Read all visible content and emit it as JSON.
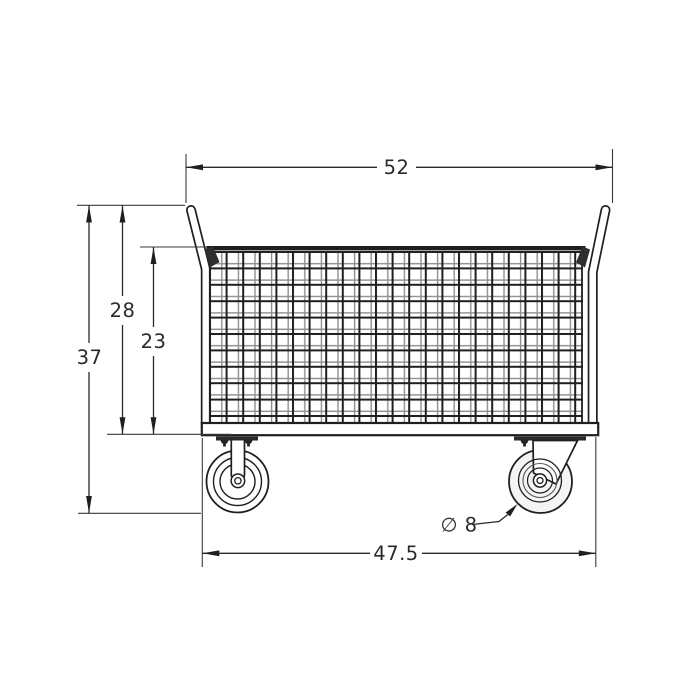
{
  "drawing": {
    "kind": "technical dimension drawing",
    "subject": "wire mesh cage platform cart, side elevation",
    "labels": {
      "overall_width": "52",
      "overall_height": "37",
      "handle_height": "28",
      "cage_height": "23",
      "base_length": "47.5",
      "wheel_diameter": "∅ 8"
    },
    "colors": {
      "line": "#1f1f1f",
      "mesh_shadow": "#8f8f8f",
      "background": "#ffffff"
    }
  }
}
